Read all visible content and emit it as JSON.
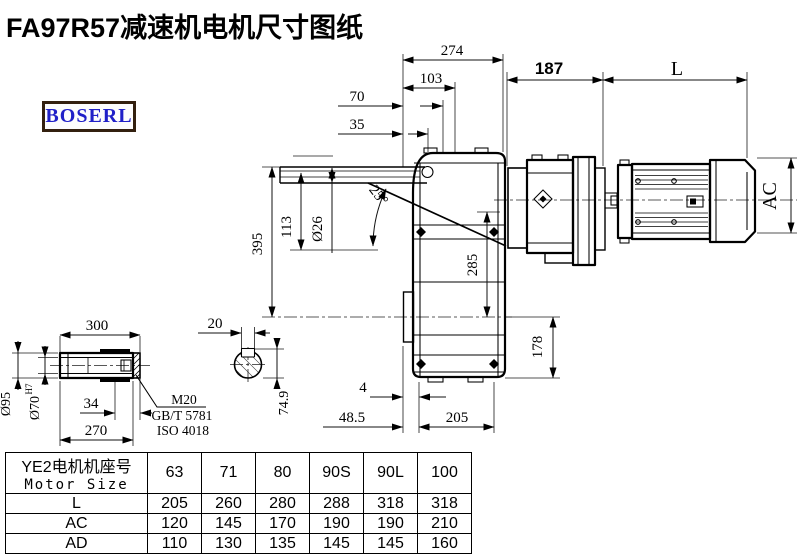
{
  "title": "FA97R57减速机电机尺寸图纸",
  "logo": {
    "text": "BOSERL"
  },
  "drawing": {
    "dims": {
      "d274": "274",
      "d103": "103",
      "d70": "70",
      "d35": "35",
      "d187": "187",
      "dL": "L",
      "dAC": "AC",
      "d395": "395",
      "d113": "113",
      "d26": "Ø26",
      "d25": "25°",
      "d285": "285",
      "d178": "178",
      "d4": "4",
      "d48_5": "48.5",
      "d205": "205",
      "d300": "300",
      "d270": "270",
      "d34": "34",
      "d95": "Ø95",
      "d70h7": "Ø70",
      "d70h7_sup": "H7",
      "m20": "M20",
      "gb": "GB/T 5781",
      "iso": "ISO 4018",
      "d20": "20",
      "d74_9": "74.9"
    }
  },
  "table": {
    "header": {
      "cn": "YE2电机机座号",
      "en": "Motor Size"
    },
    "sizes": [
      "63",
      "71",
      "80",
      "90S",
      "90L",
      "100"
    ],
    "rows": [
      {
        "label": "L",
        "values": [
          "205",
          "260",
          "280",
          "288",
          "318",
          "318"
        ]
      },
      {
        "label": "AC",
        "values": [
          "120",
          "145",
          "170",
          "190",
          "190",
          "210"
        ]
      },
      {
        "label": "AD",
        "values": [
          "110",
          "130",
          "135",
          "145",
          "145",
          "160"
        ]
      }
    ]
  }
}
